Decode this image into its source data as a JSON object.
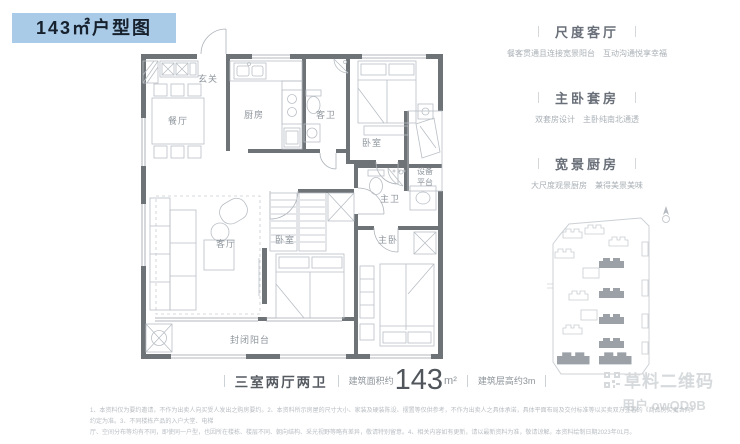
{
  "title_badge": "143㎡户型图",
  "plan": {
    "rooms": {
      "hall": "玄关",
      "dining": "餐厅",
      "kitchen": "厨房",
      "guest_bath": "客卫",
      "bedroom_north": "卧室",
      "equip_line1": "设备",
      "equip_line2": "平台",
      "master_bath": "主卫",
      "living": "客厅",
      "bedroom_south": "卧室",
      "master_bedroom": "主卧",
      "balcony": "封闭阳台"
    }
  },
  "features": [
    {
      "title": "尺度客厅",
      "desc": "餐客贯通且连接宽景阳台　互动沟通悦享幸福"
    },
    {
      "title": "主卧套房",
      "desc": "双套房设计　主卧纯南北通透"
    },
    {
      "title": "宽景厨房",
      "desc": "大尺度观景厨房　兼得美景美味"
    }
  ],
  "spec": {
    "layout": "三室两厅两卫",
    "area_label": "建筑面积约",
    "area_value": "143",
    "area_unit": "m²",
    "height_label": "建筑层高约3m"
  },
  "watermark": {
    "brand": "草料二维码",
    "user": "用户 owQD9B"
  },
  "disclaimer": {
    "line1": "1、本资料仅为要约邀请，不作为出卖人向买受人发出之购房要约。2、本资料所示房屋的尺寸大小、家装及硬装陈设、摆置等仅供参考，不作为出卖人之具体承诺，具体平面布局及交付标准等以买卖双方签署的《商品房买卖合同》约定为准。3、不同楼栋产品的入户大堂、电梯",
    "line2": "厅、空间分布等均有不同，即使同一户型，也因所在楼栋、楼层不同、朝向结构、采光视野等略有差异，敬请特别留意。4、相关内容如有更新，请以最新资料为准，敬请谅解。本资料绘制日期2023年01月。"
  },
  "colors": {
    "badge_bg": "#a9cbe7",
    "badge_text": "#16212d",
    "wall": "#6e7377",
    "furniture_line": "#b9bfc5",
    "plan_label": "#8d959c",
    "feature_title": "#6a7079",
    "feature_desc": "#a9b0b6",
    "spec_text": "#555b61",
    "divider": "#cdd2d6",
    "watermark": "#d7dadc",
    "disclaimer": "#b9bec3",
    "site_dark": "#9ba1a7",
    "site_light": "#c8cdd2"
  }
}
